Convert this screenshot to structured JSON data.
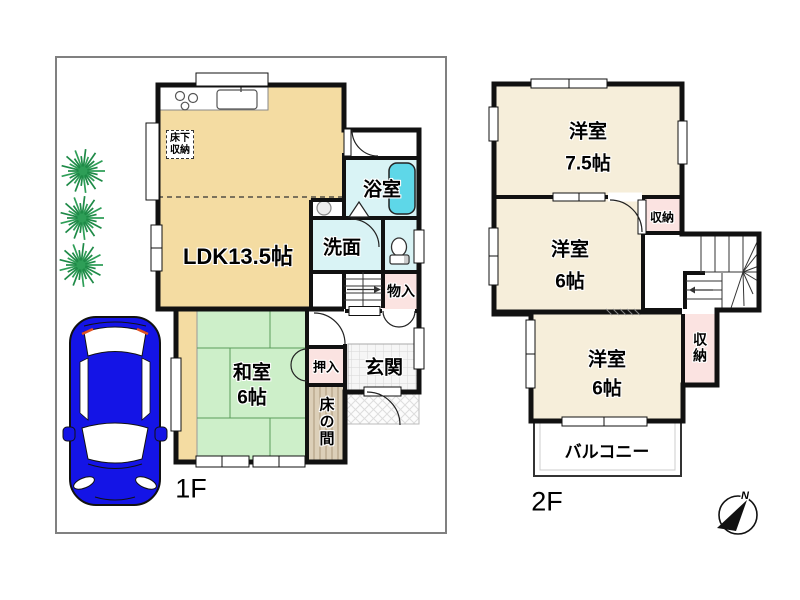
{
  "floor1": {
    "floor_label": "1F",
    "ldk_label": "LDK13.5帖",
    "underfloor_storage_line1": "床下",
    "underfloor_storage_line2": "収納",
    "bathroom_label": "浴室",
    "washroom_label": "洗面",
    "storage_label": "物入",
    "closet_label": "押入",
    "tokonoma_label": "床の間",
    "entrance_label": "玄関",
    "washitsu_line1": "和室",
    "washitsu_line2": "6帖"
  },
  "floor2": {
    "floor_label": "2F",
    "room75_line1": "洋室",
    "room75_line2": "7.5帖",
    "room6_mid_line1": "洋室",
    "room6_mid_line2": "6帖",
    "room6_btm_line1": "洋室",
    "room6_btm_line2": "6帖",
    "closet_mid_label": "収納",
    "closet_btm_label": "収納",
    "balcony_label": "バルコニー"
  },
  "compass": {
    "north_label": "N"
  },
  "colors": {
    "room_tan": "#F4DCA2",
    "tatami_green": "#CDEFC9",
    "wet_cyan": "#D9F3F5",
    "tub_cyan": "#5ED7E8",
    "closet_pink": "#FBE3E1",
    "cream": "#F6EEDA",
    "car_blue": "#1414E6",
    "tree_green": "#2E9E57",
    "wall": "#111111"
  }
}
